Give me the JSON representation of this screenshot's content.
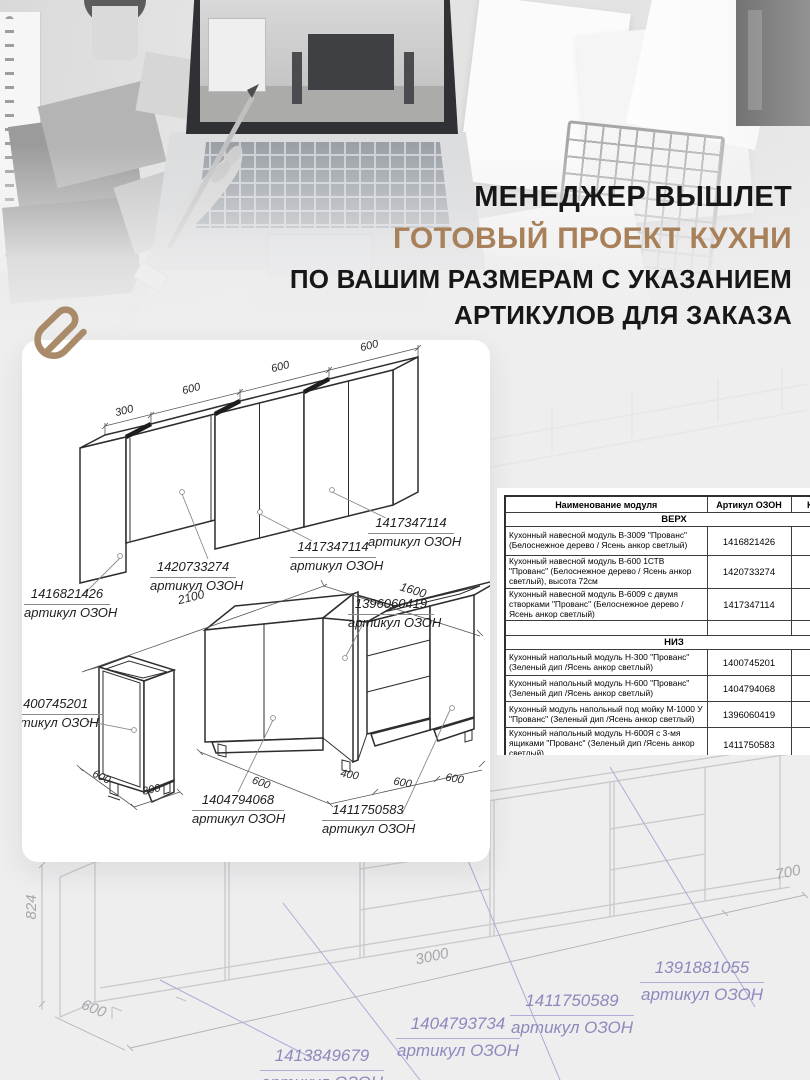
{
  "colors": {
    "accent_brown": "#a8815a",
    "page_bg": "#eeeeef",
    "purple_label": "#8d89bd",
    "card_bg": "#ffffff"
  },
  "headline": {
    "line1": "МЕНЕДЖЕР ВЫШЛЕТ",
    "line2": "ГОТОВЫЙ ПРОЕКТ КУХНИ",
    "line3": "ПО ВАШИМ РАЗМЕРАМ С УКАЗАНИЕМ",
    "line4": "АРТИКУЛОВ ДЛЯ ЗАКАЗА"
  },
  "plan": {
    "upper": {
      "dims": [
        "300",
        "600",
        "600",
        "600"
      ],
      "labels": [
        {
          "num": "1416821426",
          "cap": "артикул ОЗОН"
        },
        {
          "num": "1420733274",
          "cap": "артикул ОЗОН"
        },
        {
          "num": "1417347114",
          "cap": "артикул ОЗОН"
        },
        {
          "num": "1417347114",
          "cap": "артикул ОЗОН"
        }
      ]
    },
    "lower": {
      "run_left": "2100",
      "run_right": "1600",
      "left_depth": "600",
      "left_width": "300",
      "bottom": [
        "600",
        "400",
        "600",
        "600"
      ],
      "labels": [
        {
          "num": "1400745201",
          "cap": "артикул ОЗОН"
        },
        {
          "num": "1396060419",
          "cap": "артикул ОЗОН"
        },
        {
          "num": "1404794068",
          "cap": "артикул ОЗОН"
        },
        {
          "num": "1411750583",
          "cap": "артикул ОЗОН"
        }
      ]
    }
  },
  "table": {
    "headers": [
      "Наименование модуля",
      "Артикул ОЗОН",
      "Кол-"
    ],
    "sections": [
      {
        "title": "ВЕРХ",
        "rows": [
          {
            "name": "Кухонный навесной модуль В-3009 \"Прованс\" (Белоснежное дерево / Ясень анкор светлый)",
            "art": "1416821426"
          },
          {
            "name": "Кухонный навесной модуль В-600 1СТВ \"Прованс\" (Белоснежное дерево / Ясень анкор светлый), высота 72см",
            "art": "1420733274"
          },
          {
            "name": "Кухонный навесной модуль В-6009 с двумя створками \"Прованс\" (Белоснежное дерево / Ясень анкор светлый)",
            "art": "1417347114"
          },
          {
            "name": "",
            "art": ""
          }
        ]
      },
      {
        "title": "НИЗ",
        "rows": [
          {
            "name": "Кухонный напольный модуль Н-300 \"Прованс\" (Зеленый дип /Ясень анкор светлый)",
            "art": "1400745201"
          },
          {
            "name": "Кухонный напольный модуль Н-600 \"Прованс\" (Зеленый дип /Ясень анкор светлый)",
            "art": "1404794068"
          },
          {
            "name": "Кухонный модуль напольный под мойку М-1000 У \"Прованс\" (Зеленый дип /Ясень анкор светлый)",
            "art": "1396060419"
          },
          {
            "name": "Кухонный напольный модуль Н-600Я с 3-мя ящиками \"Прованс\" (Зеленый дип /Ясень анкор светлый)",
            "art": "1411750583"
          },
          {
            "name": "",
            "art": ""
          },
          {
            "name": "",
            "art": ""
          }
        ]
      }
    ]
  },
  "background": {
    "dims": {
      "height": "824",
      "depth": "600",
      "length": "3000",
      "right": "700"
    },
    "labels": [
      {
        "num": "1413849679",
        "cap": "артикул ОЗОН"
      },
      {
        "num": "1404793734",
        "cap": "артикул ОЗОН"
      },
      {
        "num": "1411750589",
        "cap": "артикул ОЗОН"
      },
      {
        "num": "1391881055",
        "cap": "артикул ОЗОН"
      }
    ]
  }
}
